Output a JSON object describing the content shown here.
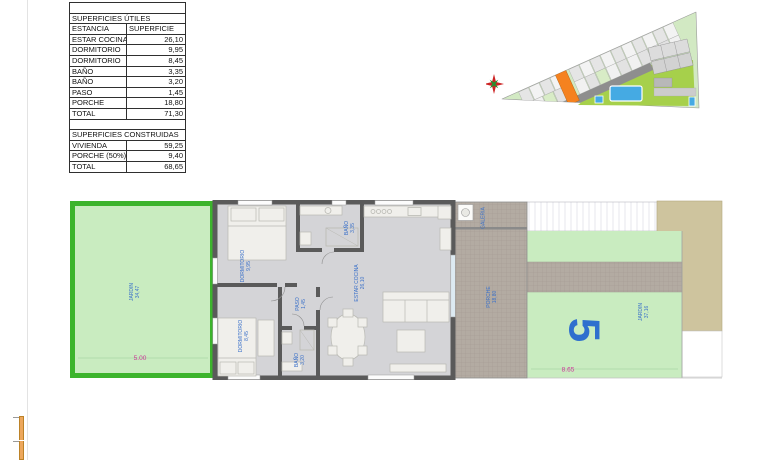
{
  "area_table": {
    "utiles_title": "SUPERFICIES ÚTILES",
    "header": {
      "estancia": "ESTANCIA",
      "superficie": "SUPERFICIE"
    },
    "utiles_rows": [
      {
        "label": "ESTAR COCINA",
        "value": "26,10"
      },
      {
        "label": "DORMITORIO",
        "value": "9,95"
      },
      {
        "label": "DORMITORIO",
        "value": "8,45"
      },
      {
        "label": "BAÑO",
        "value": "3,35"
      },
      {
        "label": "BAÑO",
        "value": "3,20"
      },
      {
        "label": "PASO",
        "value": "1,45"
      },
      {
        "label": "PORCHE",
        "value": "18,80"
      }
    ],
    "utiles_total": {
      "label": "TOTAL",
      "value": "71,30"
    },
    "construidas_title": "SUPERFICIES CONSTRUIDAS",
    "construidas_rows": [
      {
        "label": "VIVIENDA",
        "value": "59,25"
      },
      {
        "label": "PORCHE (50%)",
        "value": "9,40"
      }
    ],
    "construidas_total": {
      "label": "TOTAL",
      "value": "68,65"
    }
  },
  "floor_plan": {
    "unit_number": "5",
    "rooms": {
      "jardin_left": {
        "name": "JARDIN",
        "area": "34,47"
      },
      "dormitorio_1": {
        "name": "DORMITORIO",
        "area": "9,95"
      },
      "bano_1": {
        "name": "BAÑO",
        "area": "3,35"
      },
      "dormitorio_2": {
        "name": "DORMITORIO",
        "area": "8,45"
      },
      "paso": {
        "name": "PASO",
        "area": "1,45"
      },
      "bano_2": {
        "name": "BAÑO",
        "area": "3,20"
      },
      "estar_cocina": {
        "name": "ESTAR COCINA",
        "area": "26,10"
      },
      "porche": {
        "name": "PORCHE",
        "area": "18,80"
      },
      "galeria": {
        "name": "GALERIA",
        "area": ""
      },
      "jardin_right": {
        "name": "JARDIN",
        "area": "37,16"
      }
    },
    "dimensions": {
      "jardin_left_width": "5.00",
      "jardin_right_width": "8.65"
    }
  },
  "colors": {
    "garden_border_green": "#3cb42c",
    "garden_fill": "#c9ecc0",
    "wall_gray": "#5a5a5a",
    "room_label_blue": "#3a70c9",
    "dimension_magenta": "#cc3399",
    "highlight_orange": "#f5821f",
    "pool_blue": "#45aae3",
    "tile_taupe": "#b3aba2",
    "beige": "#cec49e"
  }
}
